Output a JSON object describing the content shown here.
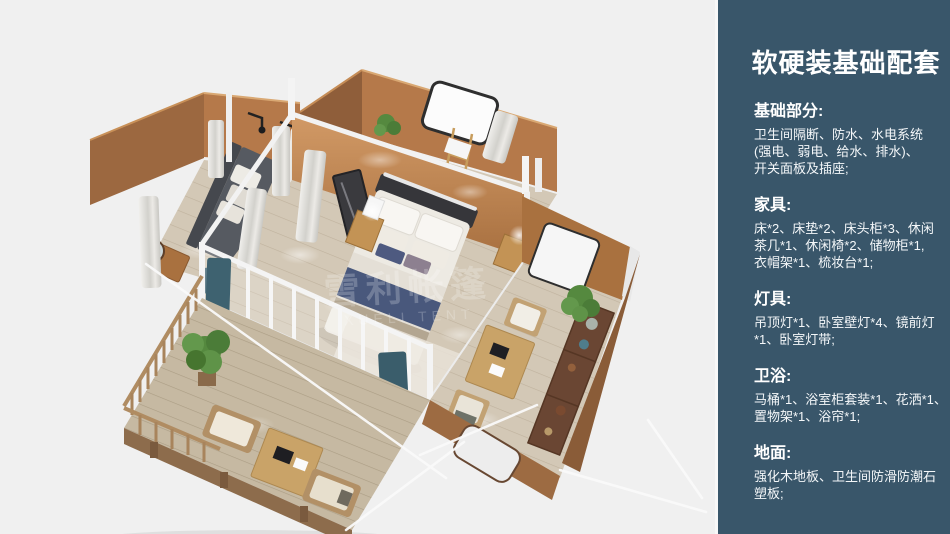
{
  "panel": {
    "background_color": "#39566a",
    "text_color": "#ffffff",
    "title": "软硬装基础配套",
    "sections": [
      {
        "heading": "基础部分:",
        "lines": [
          "卫生间隔断、防水、水电系统",
          "(强电、弱电、给水、排水)、",
          "开关面板及插座;"
        ]
      },
      {
        "heading": "家具:",
        "lines": [
          "床*2、床垫*2、床头柜*3、休闲",
          "茶几*1、休闲椅*2、储物柜*1,",
          "衣帽架*1、梳妆台*1;"
        ]
      },
      {
        "heading": "灯具:",
        "lines": [
          "吊顶灯*1、卧室壁灯*4、镜前灯",
          "*1、卧室灯带;"
        ]
      },
      {
        "heading": "卫浴:",
        "lines": [
          "马桶*1、浴室柜套装*1、花洒*1、",
          "置物架*1、浴帘*1;"
        ]
      },
      {
        "heading": "地面:",
        "lines": [
          "强化木地板、卫生间防滑防潮石",
          "塑板;"
        ]
      }
    ]
  },
  "render": {
    "watermark": {
      "cn": "雪利帐篷",
      "en": "XUELI TENT"
    },
    "colors": {
      "background": "#f0f0f0",
      "tent_wall": "#b5794a",
      "white_frame": "#f2f2f2",
      "curtain_teal": "#3e6270",
      "bed_runner_navy": "#49587c",
      "wood_floor": "#d3c8b6"
    }
  }
}
